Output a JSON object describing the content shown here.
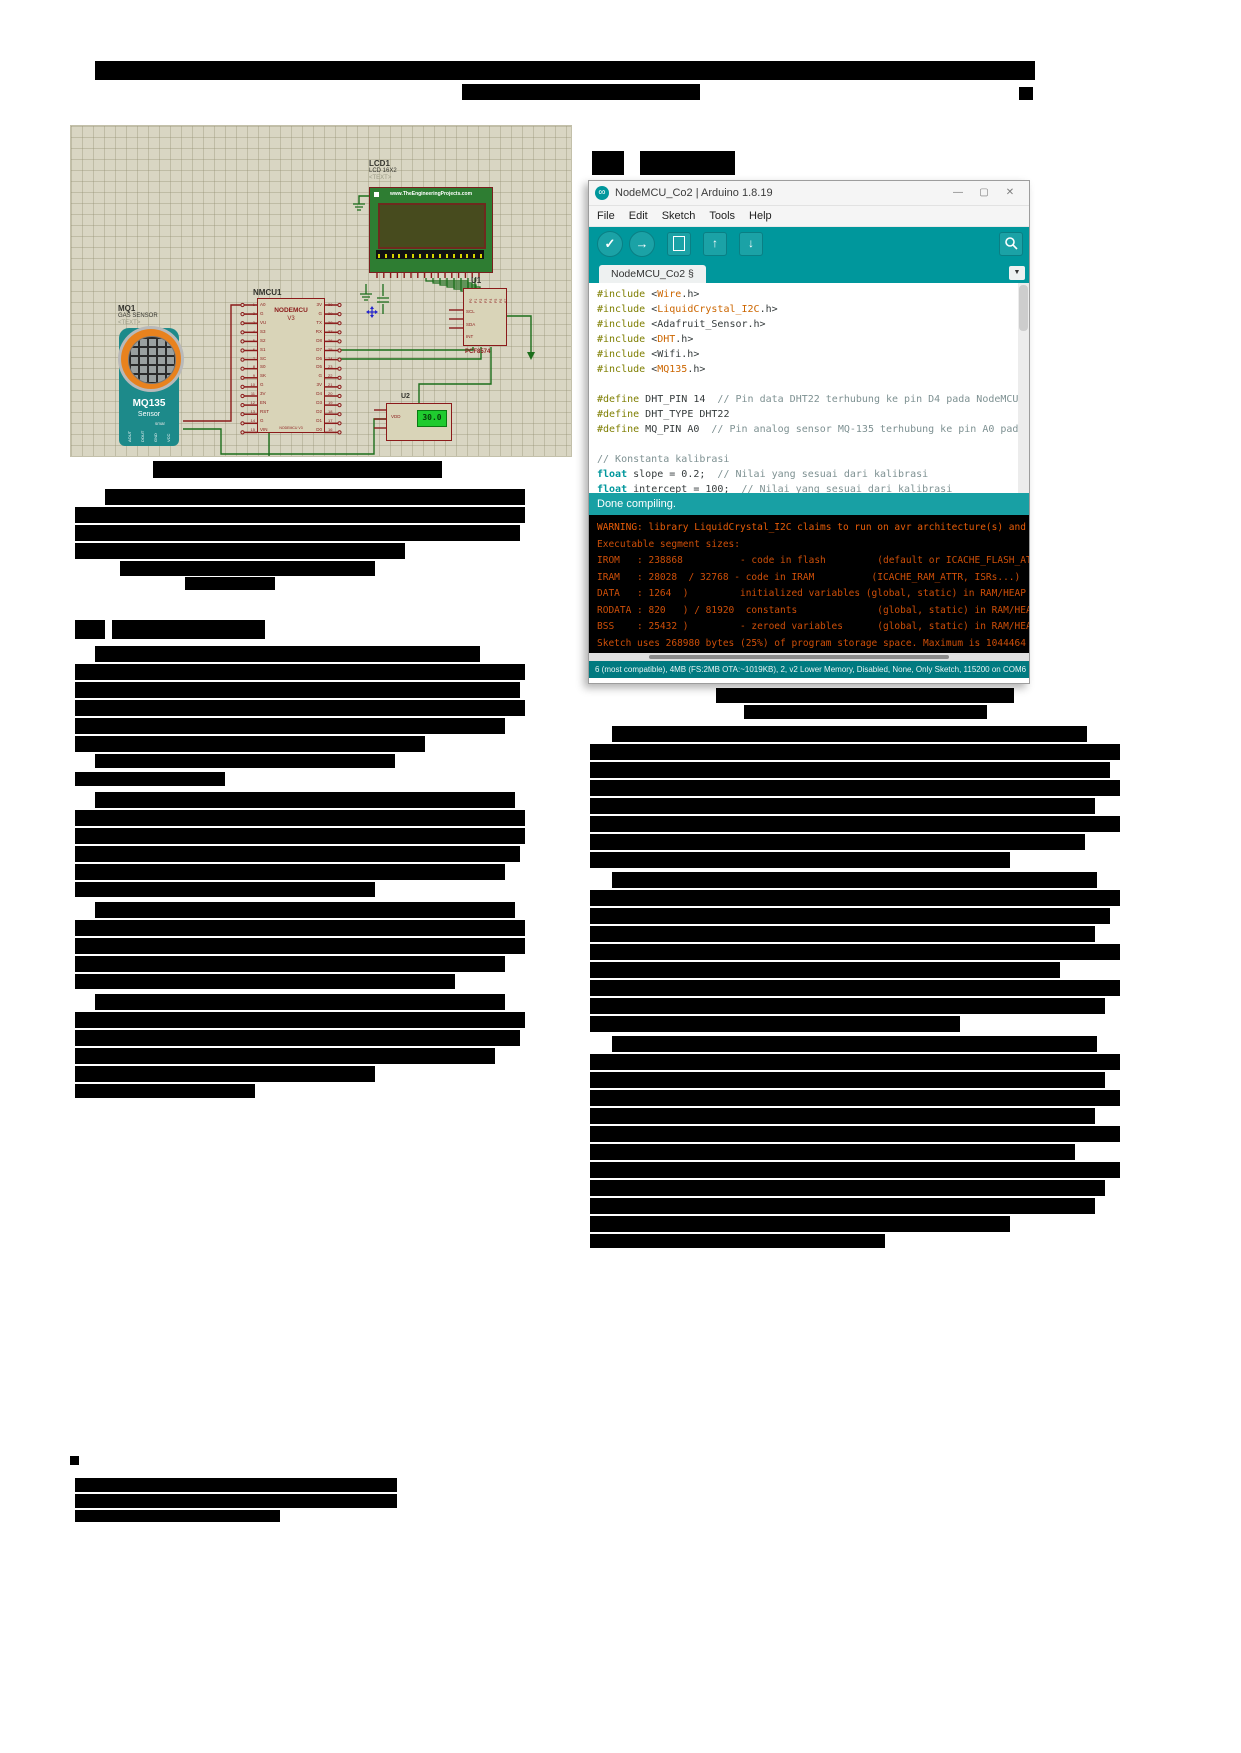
{
  "proteus_figure": {
    "lcd": {
      "ref": "LCD1",
      "value": "LCD 16X2",
      "text_tag": "<TEXT>",
      "brand": "www.TheEngineeringProjects.com"
    },
    "gas_sensor": {
      "ref": "MQ1",
      "value": "GAS SENSOR",
      "text_tag": "<TEXT>",
      "label": "MQ135",
      "sublabel": "Sensor",
      "small_label": "smar",
      "pins": [
        "AOUT",
        "DOUT",
        "GND",
        "VCC"
      ]
    },
    "nodemcu": {
      "ref": "NMCU1",
      "label": "NODEMCU",
      "version": "V3",
      "bottom_label": "NODEMCU V3",
      "left_pins": [
        "A0",
        "G",
        "VU",
        "S3",
        "S2",
        "S1",
        "SC",
        "S0",
        "SK",
        "G",
        "3V",
        "EN",
        "RST",
        "G",
        "VIN"
      ],
      "left_numbers": [
        "1",
        "2",
        "3",
        "4",
        "5",
        "6",
        "7",
        "8",
        "9",
        "10",
        "11",
        "12",
        "13",
        "14",
        "15"
      ],
      "right_pins": [
        "3V",
        "G",
        "TX",
        "RX",
        "D8",
        "D7",
        "D6",
        "D5",
        "G",
        "3V",
        "D4",
        "D3",
        "D2",
        "D1",
        "D0"
      ],
      "right_numbers": [
        "30",
        "29",
        "28",
        "27",
        "26",
        "25",
        "24",
        "23",
        "22",
        "21",
        "20",
        "19",
        "18",
        "17",
        "16"
      ]
    },
    "u1": {
      "ref": "U1",
      "value": "PCF8574",
      "left_pins": [
        "SCL",
        "SDA",
        "INT"
      ],
      "top_pins": [
        "P0",
        "P1",
        "P2",
        "P3",
        "P4",
        "P5",
        "P6",
        "P7"
      ]
    },
    "u2": {
      "ref": "U2",
      "pin_label": "VDD",
      "display_value": "30.0"
    }
  },
  "arduino_ide": {
    "window_title": "NodeMCU_Co2 | Arduino 1.8.19",
    "app_icon_glyph": "∞",
    "window_controls": {
      "minimize": "—",
      "maximize": "▢",
      "close": "✕"
    },
    "menus": [
      "File",
      "Edit",
      "Sketch",
      "Tools",
      "Help"
    ],
    "toolbar": {
      "verify": "✓",
      "upload": "→",
      "open": "↑",
      "save": "↓"
    },
    "tab_label": "NodeMCU_Co2",
    "tab_suffix": "§",
    "tab_menu_glyph": "▼",
    "code_lines": [
      [
        [
          "#include ",
          "k"
        ],
        [
          "<",
          "p"
        ],
        [
          "Wire",
          "o"
        ],
        [
          ".h>",
          "p"
        ]
      ],
      [
        [
          "#include ",
          "k"
        ],
        [
          "<",
          "p"
        ],
        [
          "LiquidCrystal_I2C",
          "o"
        ],
        [
          ".h>",
          "p"
        ]
      ],
      [
        [
          "#include ",
          "k"
        ],
        [
          "<Adafruit_Sensor.h>",
          "p"
        ]
      ],
      [
        [
          "#include ",
          "k"
        ],
        [
          "<",
          "p"
        ],
        [
          "DHT",
          "o"
        ],
        [
          ".h>",
          "p"
        ]
      ],
      [
        [
          "#include ",
          "k"
        ],
        [
          "<Wifi.h>",
          "p"
        ]
      ],
      [
        [
          "#include ",
          "k"
        ],
        [
          "<",
          "p"
        ],
        [
          "MQ135",
          "o"
        ],
        [
          ".h>",
          "p"
        ]
      ],
      [],
      [
        [
          "#define ",
          "k"
        ],
        [
          "DHT_PIN 14  ",
          "p"
        ],
        [
          "// Pin data DHT22 terhubung ke pin D4 pada NodeMCU",
          "c"
        ]
      ],
      [
        [
          "#define ",
          "k"
        ],
        [
          "DHT_TYPE DHT22",
          "p"
        ]
      ],
      [
        [
          "#define ",
          "k"
        ],
        [
          "MQ_PIN A0  ",
          "p"
        ],
        [
          "// Pin analog sensor MQ-135 terhubung ke pin A0 pada NodeMCU",
          "c"
        ]
      ],
      [],
      [
        [
          "// Konstanta kalibrasi",
          "c"
        ]
      ],
      [
        [
          "float",
          "t"
        ],
        [
          " slope = 0.2;  ",
          "p"
        ],
        [
          "// Nilai yang sesuai dari kalibrasi",
          "c"
        ]
      ],
      [
        [
          "float",
          "t"
        ],
        [
          " intercept = 100;  ",
          "p"
        ],
        [
          "// Nilai yang sesuai dari kalibrasi",
          "c"
        ]
      ]
    ],
    "status_done": "Done compiling.",
    "console_lines": [
      "WARNING: library LiquidCrystal_I2C claims to run on avr architecture(s) and may be",
      "Executable segment sizes:",
      "IROM   : 238868          - code in flash         (default or ICACHE_FLASH_ATTR)",
      "IRAM   : 28028  / 32768 - code in IRAM          (ICACHE_RAM_ATTR, ISRs...)",
      "DATA   : 1264  )         initialized variables (global, static) in RAM/HEAP",
      "RODATA : 820   ) / 81920  constants              (global, static) in RAM/HEAP",
      "BSS    : 25432 )         - zeroed variables      (global, static) in RAM/HEAP",
      "Sketch uses 268980 bytes (25%) of program storage space. Maximum is 1044464 bytes."
    ],
    "statusbar_text": "6 (most compatible), 4MB (FS:2MB OTA:~1019KB), 2, v2 Lower Memory, Disabled, None, Only Sketch, 115200 on COM6",
    "colors": {
      "toolbar_teal": "#00979C",
      "console_text_orange": "#CE4F09",
      "statusbar_teal": "#007A80"
    }
  }
}
